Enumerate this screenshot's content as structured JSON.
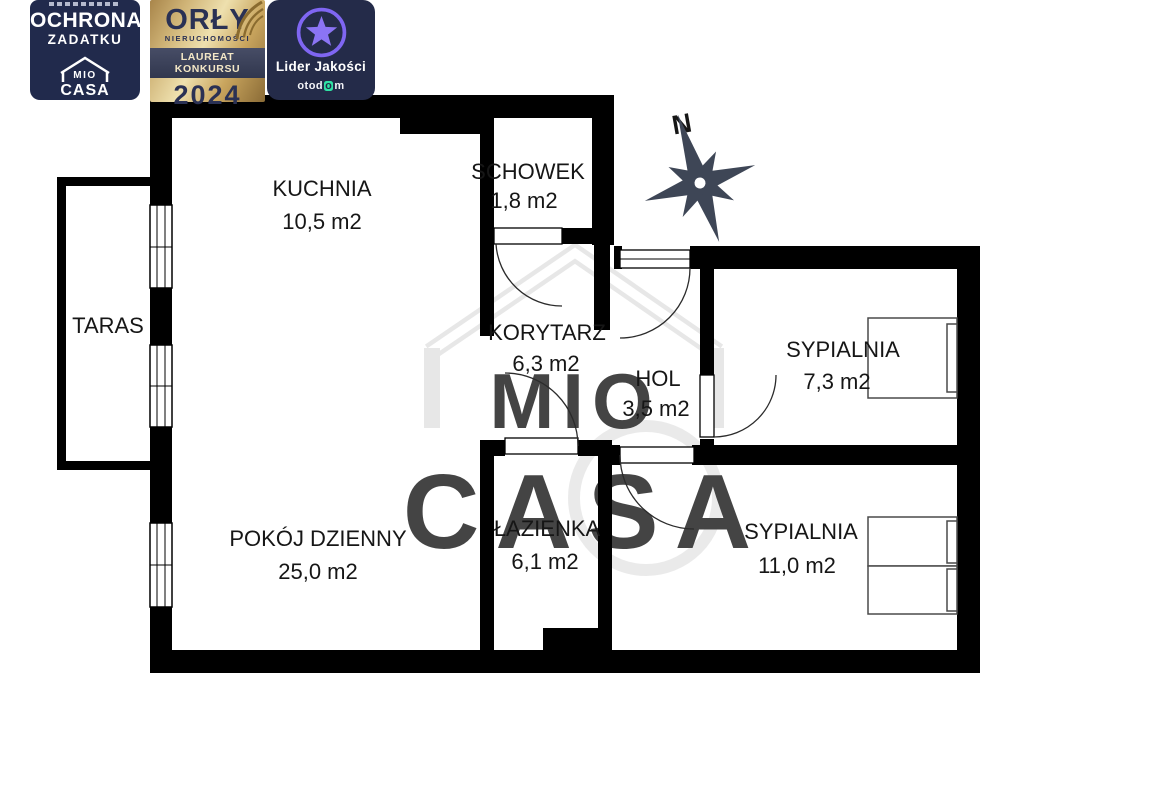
{
  "badges": {
    "deposit": {
      "line1": "OCHRONA",
      "line2": "ZADATKU",
      "logo_top": "MIO",
      "logo_bottom": "CASA"
    },
    "award": {
      "title": "ORŁY",
      "subtitle": "NIERUCHOMOŚCI",
      "ribbon": "LAUREAT KONKURSU",
      "year": "2024"
    },
    "quality": {
      "title": "Lider Jakości",
      "brand_pre": "otod",
      "brand_o": "o",
      "brand_post": "m"
    }
  },
  "compass": {
    "north_label": "N"
  },
  "watermark": {
    "top": "MIO",
    "bottom": "CASA"
  },
  "rooms": [
    {
      "id": "kuchnia",
      "name": "KUCHNIA",
      "area": "10,5 m2"
    },
    {
      "id": "schowek",
      "name": "SCHOWEK",
      "area": "1,8 m2"
    },
    {
      "id": "taras",
      "name": "TARAS",
      "area": ""
    },
    {
      "id": "korytarz",
      "name": "KORYTARZ",
      "area": "6,3 m2"
    },
    {
      "id": "hol",
      "name": "HOL",
      "area": "3,5 m2"
    },
    {
      "id": "sypialnia-1",
      "name": "SYPIALNIA",
      "area": "7,3 m2"
    },
    {
      "id": "pokoj-dzienny",
      "name": "POKÓJ DZIENNY",
      "area": "25,0 m2"
    },
    {
      "id": "lazienka",
      "name": "ŁAZIENKA",
      "area": "6,1 m2"
    },
    {
      "id": "sypialnia-2",
      "name": "SYPIALNIA",
      "area": "11,0 m2"
    }
  ],
  "colors": {
    "wall": "#000000",
    "badge_navy": "#212a4c",
    "gold_light": "#eee0ae",
    "gold_dark": "#8a6b36",
    "accent_purple": "#8b74f4",
    "otodom_green": "#2fe3a4",
    "watermark_gray": "#e3e3e3",
    "compass_slate": "#3e4656"
  }
}
